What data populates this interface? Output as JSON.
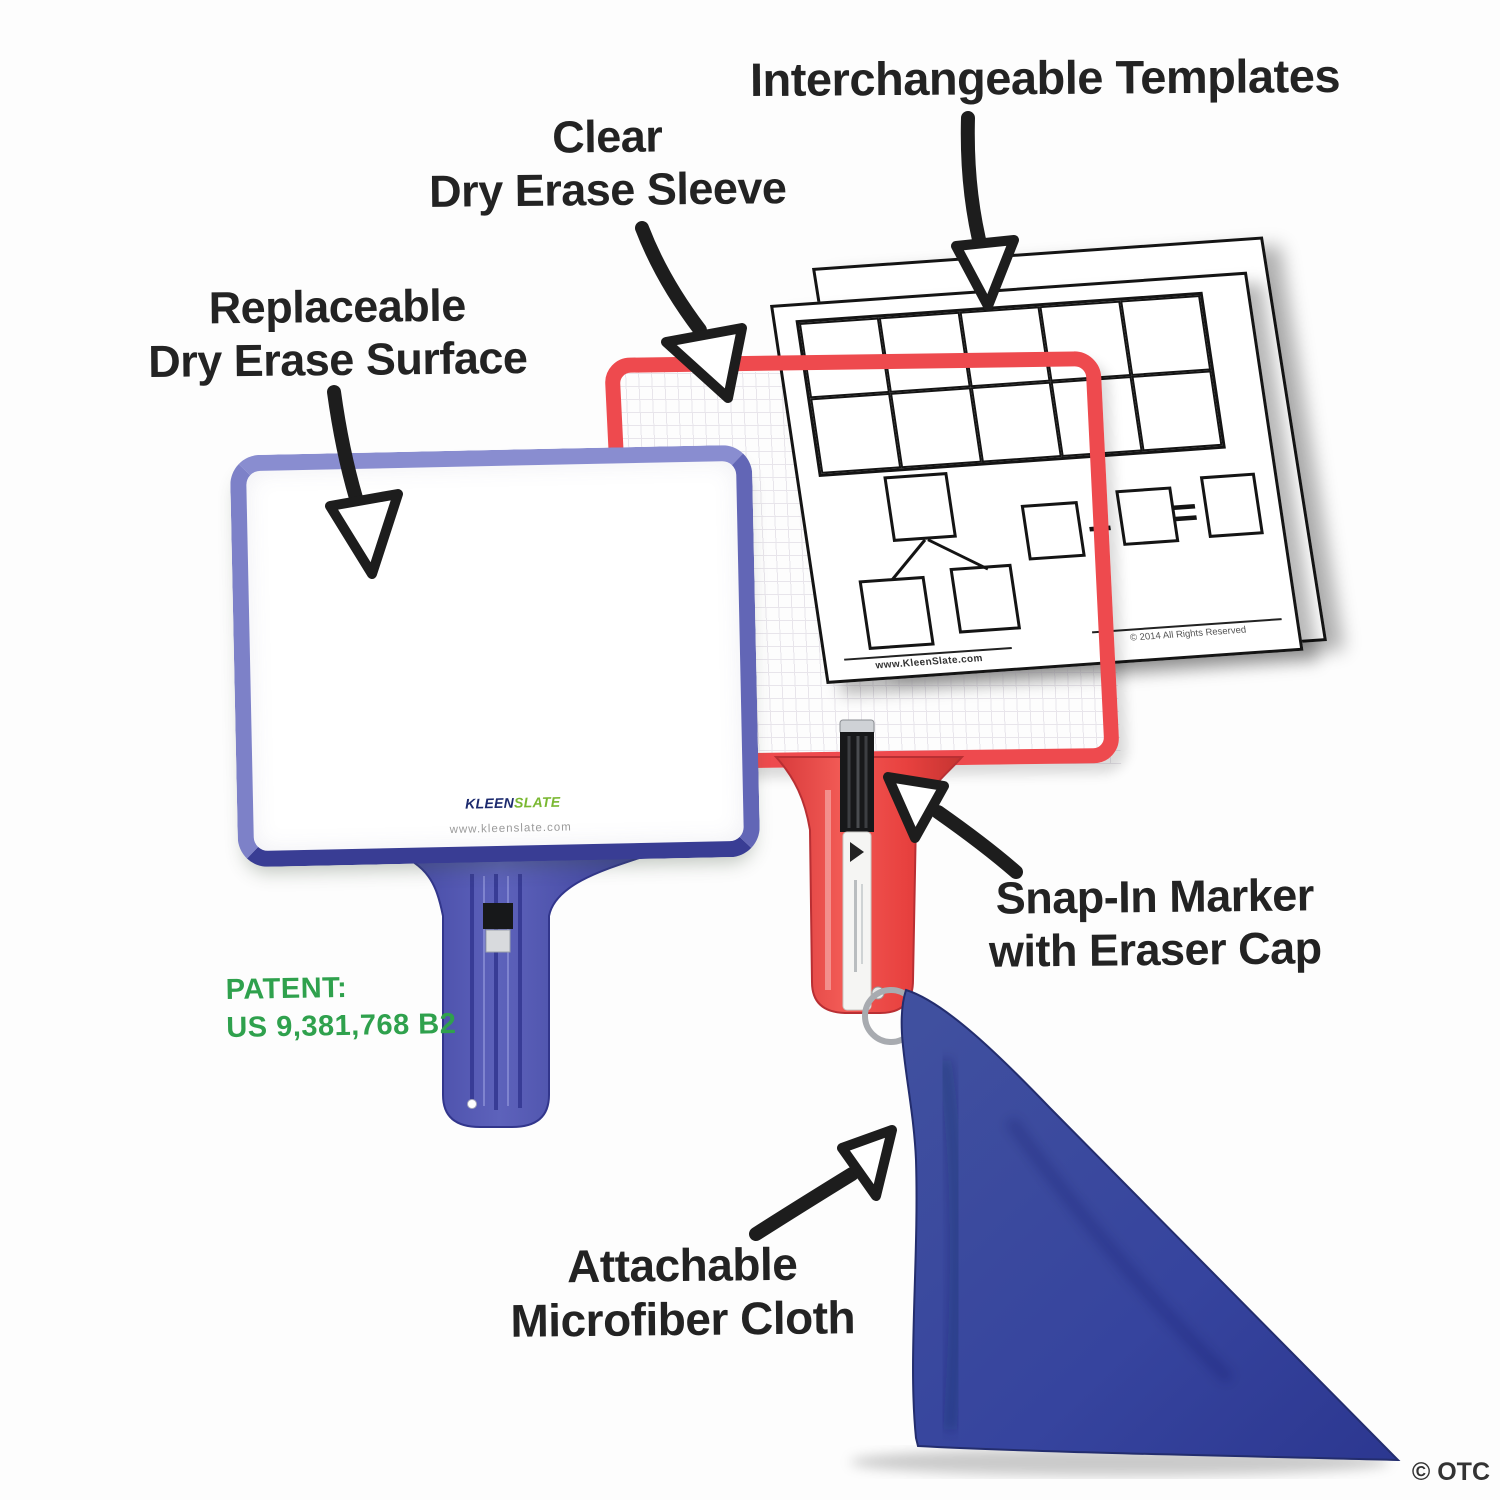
{
  "annotations": {
    "templates": {
      "label": "Interchangeable Templates"
    },
    "sleeve": {
      "line1": "Clear",
      "line2": "Dry Erase Sleeve"
    },
    "surface": {
      "line1": "Replaceable",
      "line2": "Dry Erase Surface"
    },
    "marker": {
      "line1": "Snap-In Marker",
      "line2": "with Eraser Cap"
    },
    "cloth": {
      "line1": "Attachable",
      "line2": "Microfiber Cloth"
    }
  },
  "patent": {
    "line1": "PATENT:",
    "line2": "US 9,381,768 B2"
  },
  "board": {
    "logo_kleen": "KLEEN",
    "logo_slate": "SLATE",
    "website": "www.kleenslate.com"
  },
  "template_sheet": {
    "website": "www.KleenSlate.com",
    "copyright": "© 2014 All Rights Reserved",
    "plus_sign": "+",
    "equals_sign": "=",
    "ten_frame": {
      "rows": 2,
      "cols": 5
    }
  },
  "credit": "© OTC",
  "icons": {
    "templates_arrow": "arrow-down",
    "sleeve_arrow": "arrow-down-right",
    "surface_arrow": "arrow-down",
    "marker_arrow": "arrow-up-left",
    "cloth_arrow": "arrow-up-right"
  },
  "colors": {
    "blue-paddle": "#4d51a8",
    "red-paddle": "#ee4a4e",
    "cloth-blue": "#36449e",
    "patent-green": "#2fa14d",
    "ink": "#1d1d1d",
    "sheet-line": "#141414"
  }
}
